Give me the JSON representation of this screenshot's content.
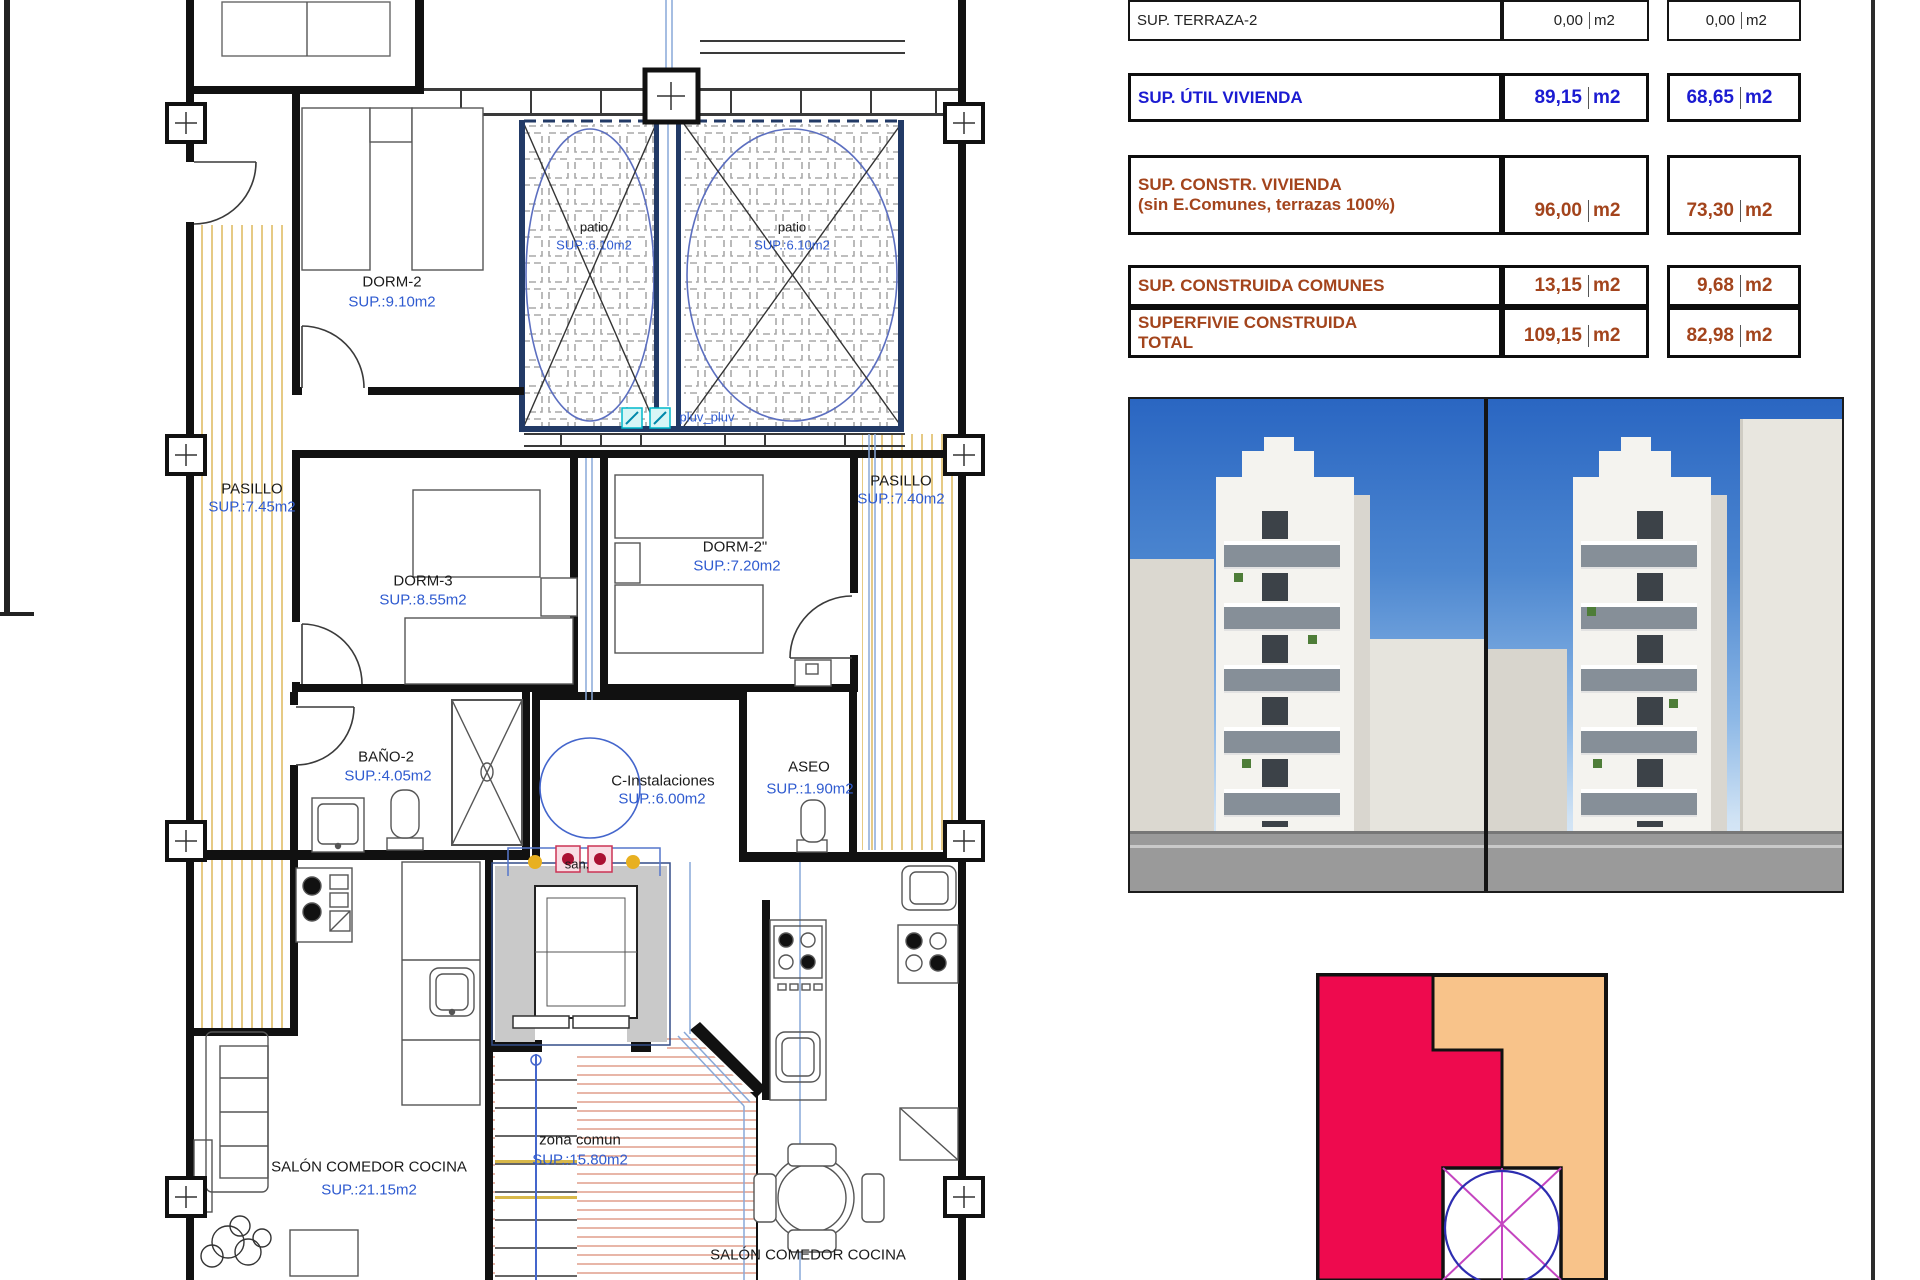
{
  "plan": {
    "rooms": [
      {
        "name": "DORM-2",
        "area": "SUP.:9.10m2"
      },
      {
        "name": "patio",
        "area": "SUP.:6.10m2"
      },
      {
        "name": "patio",
        "area": "SUP.:6.10m2"
      },
      {
        "name": "PASILLO",
        "area": "SUP.:7.45m2"
      },
      {
        "name": "PASILLO",
        "area": "SUP.:7.40m2"
      },
      {
        "name": "DORM-3",
        "area": "SUP.:8.55m2"
      },
      {
        "name": "DORM-2\"",
        "area": "SUP.:7.20m2"
      },
      {
        "name": "BAÑO-2",
        "area": "SUP.:4.05m2"
      },
      {
        "name": "C-Instalaciones",
        "area": "SUP.:6.00m2"
      },
      {
        "name": "ASEO",
        "area": "SUP.:1.90m2"
      },
      {
        "name": "zona comun",
        "area": "SUP.:15.80m2"
      },
      {
        "name": "SALÓN COMEDOR COCINA",
        "area": "SUP.:21.15m2"
      },
      {
        "name": "SALÓN COMEDOR COCINA",
        "area": ""
      }
    ],
    "notes": {
      "pluv": "pluv_pluv",
      "san": "san."
    }
  },
  "table": {
    "rows": [
      {
        "label": "SUP. TERRAZA-2",
        "v1": "0,00",
        "u1": "m2",
        "v2": "0,00",
        "u2": "m2"
      },
      {
        "label": "SUP. ÚTIL VIVIENDA",
        "v1": "89,15",
        "u1": "m2",
        "v2": "68,65",
        "u2": "m2"
      },
      {
        "label": "SUP. CONSTR. VIVIENDA",
        "label2": "(sin E.Comunes, terrazas 100%)",
        "v1": "96,00",
        "u1": "m2",
        "v2": "73,30",
        "u2": "m2"
      },
      {
        "label": "SUP. CONSTRUIDA COMUNES",
        "v1": "13,15",
        "u1": "m2",
        "v2": "9,68",
        "u2": "m2"
      },
      {
        "label": "SUPERFIVIE CONSTRUIDA",
        "label2": "TOTAL",
        "v1": "109,15",
        "u1": "m2",
        "v2": "82,98",
        "u2": "m2"
      }
    ]
  },
  "colors": {
    "accent_blue": "#1b1bd1",
    "accent_brown": "#a3441c",
    "plan_label_blue": "#2f5bd0",
    "terrace_stripe_yellow": "#e3c477",
    "stair_hatch_salmon": "#e2a492",
    "diagram_red": "#ee0a4e",
    "diagram_orange": "#f8c38a",
    "sky_blue": "#2a66c2"
  }
}
